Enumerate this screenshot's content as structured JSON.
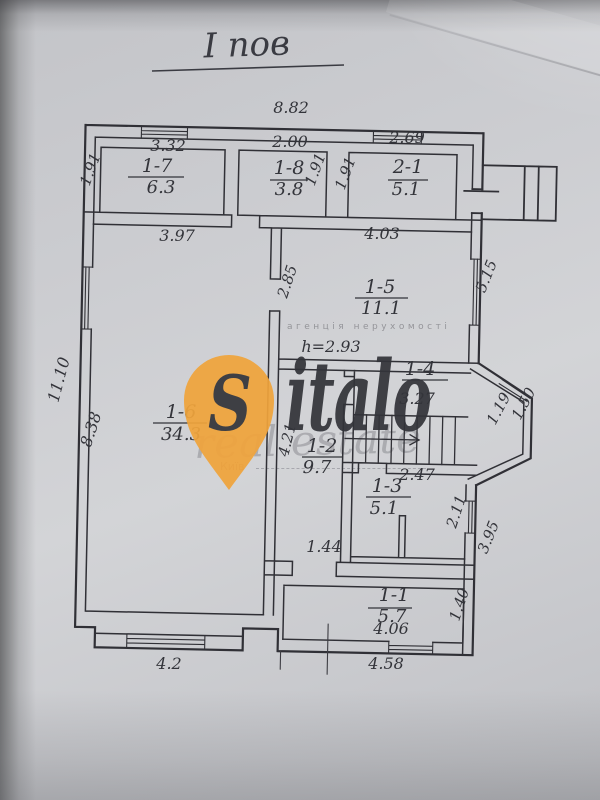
{
  "title": "I пов",
  "rooms": {
    "r1_7": {
      "id": "1-7",
      "area": "6.3"
    },
    "r1_8": {
      "id": "1-8",
      "area": "3.8"
    },
    "r2_1": {
      "id": "2-1",
      "area": "5.1"
    },
    "r1_5": {
      "id": "1-5",
      "area": "11.1"
    },
    "r1_6": {
      "id": "1-6",
      "area": "34.3"
    },
    "r1_4": {
      "id": "1-4"
    },
    "r1_2": {
      "id": "1-2",
      "area": "9.7"
    },
    "r1_3": {
      "id": "1-3",
      "area": "5.1"
    },
    "r1_1": {
      "id": "1-1",
      "area": "5.7"
    }
  },
  "dims": {
    "top_total": "8.82",
    "w1_7": "3.32",
    "w1_8": "2.00",
    "w2_1": "2.69",
    "h1_7": "1.91",
    "h1_8": "1.91",
    "h2_1": "1.91",
    "w1_6_top": "3.97",
    "w1_5": "4.03",
    "h1_5_left": "2.85",
    "h1_5_right": "5.15",
    "left_total": "11.10",
    "h1_6": "8.38",
    "ceiling_height": "h=2.93",
    "w1_4": "3.27",
    "bay_inner": "1.19",
    "bay_outer": "1.50",
    "h1_2": "4.21",
    "w1_3": "2.47",
    "h1_3": "2.11",
    "right_side": "3.95",
    "door_width": "1.44",
    "w1_1": "4.06",
    "h1_1": "1.40",
    "bottom_right": "4.58",
    "bottom_left": "4.2"
  },
  "watermark": {
    "brand_initial": "S",
    "brand_rest": "italo",
    "tagline": "агенція нерухомості",
    "script": "real estate",
    "city": "Київ",
    "accent": "#f0a43c"
  }
}
